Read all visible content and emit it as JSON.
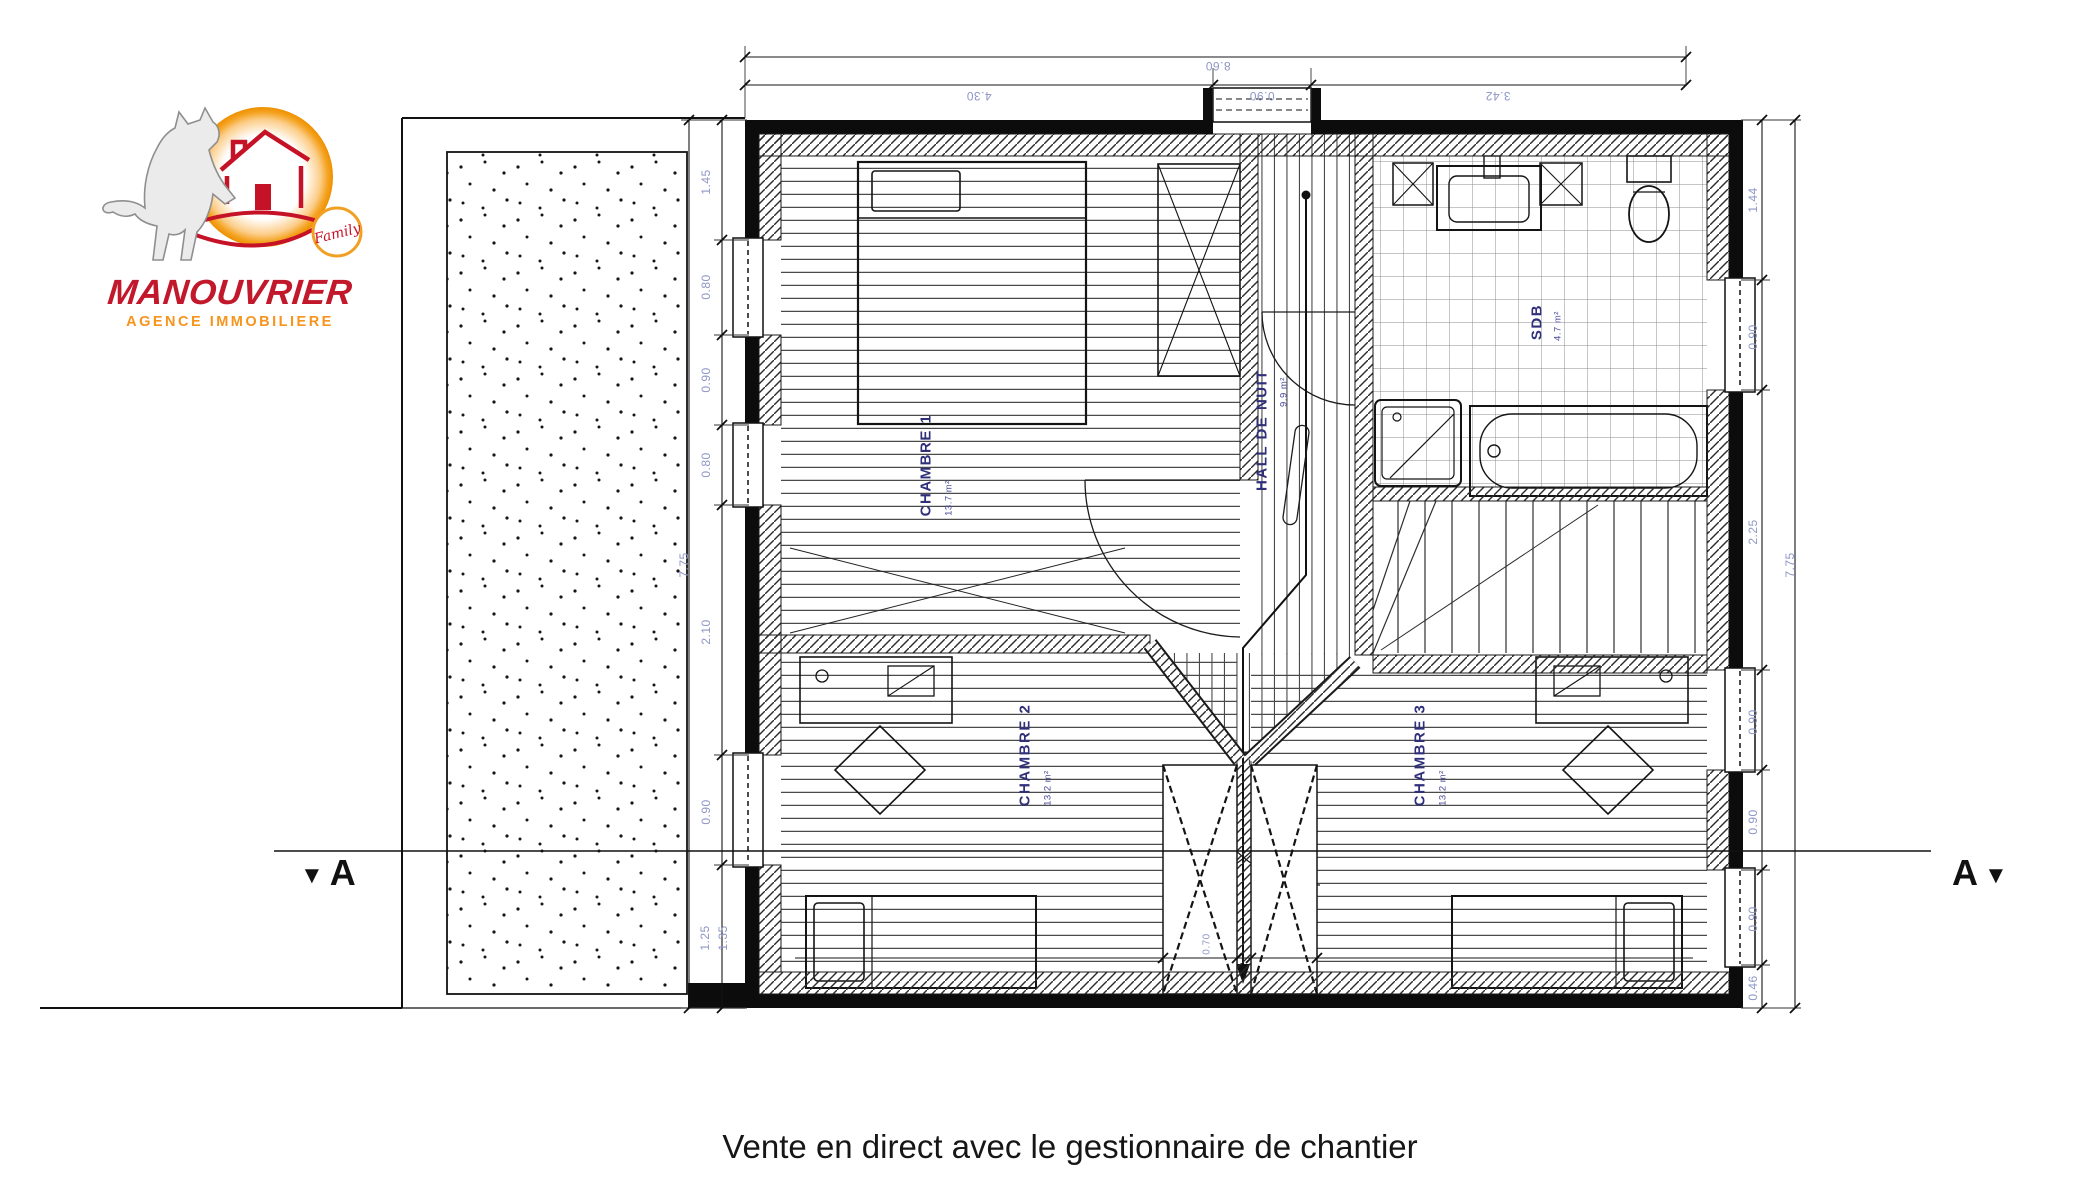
{
  "logo": {
    "brand": "MANOUVRIER",
    "tagline": "AGENCE IMMOBILIERE",
    "badge": "Family"
  },
  "colors": {
    "brand_red": "#c2182b",
    "brand_orange": "#f7941d",
    "dim_text": "#8e96c6",
    "room_label_text": "#2f2f7a"
  },
  "caption": "Vente en direct avec le gestionnaire de chantier",
  "section": {
    "letter_left": "A",
    "letter_right": "A",
    "triangle": "▼"
  },
  "rooms": {
    "chambre1": {
      "name": "CHAMBRE 1",
      "area": "13.7 m²"
    },
    "hall": {
      "name": "HALL DE NUIT",
      "area": "9.9 m²"
    },
    "sdb": {
      "name": "SDB",
      "area": "4.7 m²"
    },
    "chambre2": {
      "name": "CHAMBRE 2",
      "area": "13.2 m²"
    },
    "chambre3": {
      "name": "CHAMBRE 3",
      "area": "13.2 m²"
    }
  },
  "dims": {
    "top_total": "8.60",
    "top": [
      "4.30",
      "0.90",
      "3.42"
    ],
    "left_total": "7.75",
    "left": [
      "1.45",
      "0.80",
      "0.90",
      "0.80",
      "2.10",
      "0.90",
      "1.25"
    ],
    "left_extra": "1.35",
    "right_total": "7.75",
    "right": [
      "1.44",
      "0.90",
      "2.25",
      "0.90",
      "0.90",
      "0.90",
      "0.46"
    ],
    "interior_void": "0.70"
  }
}
